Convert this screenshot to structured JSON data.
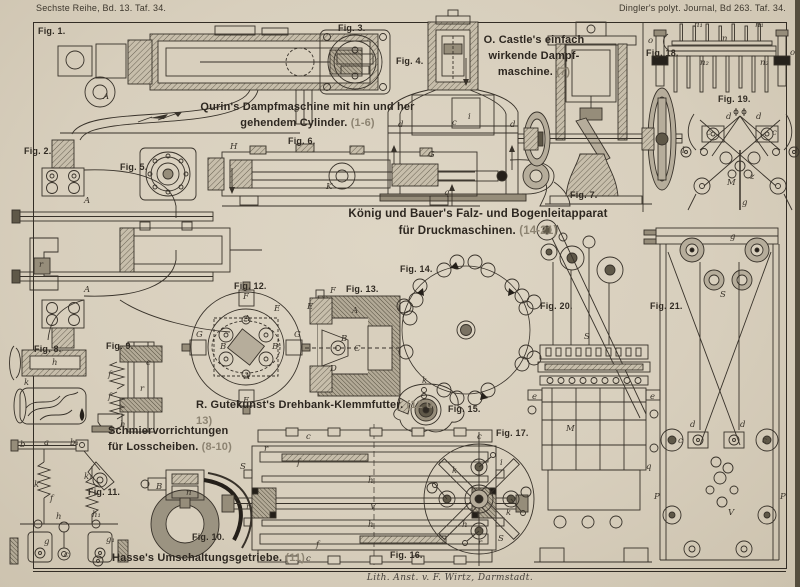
{
  "page": {
    "header_left": "Sechste Reihe, Bd. 13. Taf. 34.",
    "header_right": "Dingler's polyt. Journal, Bd 263. Taf. 34.",
    "imprint": "Lith. Anst. v. F. Wirtz, Darmstadt."
  },
  "colors": {
    "paper": "#d8cfbd",
    "ink": "#38322a",
    "metal_light": "#b6ad9b",
    "metal_mid": "#968d7a",
    "metal_dark": "#5f5848"
  },
  "captions": {
    "qurin": {
      "line1": "Qurin's Dampfmaschine mit hin und her",
      "line2": "gehendem Cylinder.",
      "ref": "(1-6)"
    },
    "castle": {
      "line1": "O. Castle's einfach",
      "line2": "wirkende Dampf-",
      "line3": "maschine.",
      "ref": "(7)"
    },
    "koenig": {
      "line1": "König und Bauer's Falz- und Bogenleitapparat",
      "line2": "für Druckmaschinen.",
      "ref": "(14-21)"
    },
    "gutekunst": {
      "text": "R. Gutekunst's Drehbank-Klemmfutter.",
      "ref": "(12 u. 13)"
    },
    "schmier": {
      "line1": "Schmiervorrichtungen",
      "line2": "für Losscheiben.",
      "ref": "(8-10)"
    },
    "hasse": {
      "text": "Hasse's Umschaltungsgetriebe.",
      "ref": "(11)"
    }
  },
  "figures": [
    {
      "id": "fig-1",
      "label": "Fig. 1."
    },
    {
      "id": "fig-2",
      "label": "Fig. 2."
    },
    {
      "id": "fig-3",
      "label": "Fig. 3."
    },
    {
      "id": "fig-4",
      "label": "Fig. 4."
    },
    {
      "id": "fig-5",
      "label": "Fig. 5."
    },
    {
      "id": "fig-6",
      "label": "Fig. 6."
    },
    {
      "id": "fig-7",
      "label": "Fig. 7."
    },
    {
      "id": "fig-8",
      "label": "Fig. 8."
    },
    {
      "id": "fig-9",
      "label": "Fig. 9."
    },
    {
      "id": "fig-10",
      "label": "Fig. 10."
    },
    {
      "id": "fig-11",
      "label": "Fig. 11."
    },
    {
      "id": "fig-12",
      "label": "Fig. 12."
    },
    {
      "id": "fig-13",
      "label": "Fig. 13."
    },
    {
      "id": "fig-14",
      "label": "Fig. 14."
    },
    {
      "id": "fig-15",
      "label": "Fig. 15."
    },
    {
      "id": "fig-16",
      "label": "Fig. 16."
    },
    {
      "id": "fig-17",
      "label": "Fig. 17."
    },
    {
      "id": "fig-18",
      "label": "Fig. 18."
    },
    {
      "id": "fig-19",
      "label": "Fig. 19."
    },
    {
      "id": "fig-20",
      "label": "Fig. 20."
    },
    {
      "id": "fig-21",
      "label": "Fig. 21."
    }
  ],
  "annotations": [
    {
      "x": 103,
      "y": 100,
      "t": "A"
    },
    {
      "x": 294,
      "y": 113,
      "t": "o"
    },
    {
      "x": 84,
      "y": 204,
      "t": "A"
    },
    {
      "x": 84,
      "y": 293,
      "t": "A"
    },
    {
      "x": 39,
      "y": 268,
      "t": "r"
    },
    {
      "x": 398,
      "y": 128,
      "t": "d"
    },
    {
      "x": 510,
      "y": 128,
      "t": "d"
    },
    {
      "x": 452,
      "y": 126,
      "t": "c"
    },
    {
      "x": 468,
      "y": 120,
      "t": "i"
    },
    {
      "x": 230,
      "y": 150,
      "t": "H"
    },
    {
      "x": 428,
      "y": 158,
      "t": "G"
    },
    {
      "x": 326,
      "y": 190,
      "t": "K"
    },
    {
      "x": 444,
      "y": 196,
      "t": "q"
    },
    {
      "x": 52,
      "y": 366,
      "t": "h"
    },
    {
      "x": 24,
      "y": 386,
      "t": "k"
    },
    {
      "x": 108,
      "y": 378,
      "t": "f"
    },
    {
      "x": 108,
      "y": 400,
      "t": "f"
    },
    {
      "x": 140,
      "y": 392,
      "t": "r"
    },
    {
      "x": 146,
      "y": 366,
      "t": "c"
    },
    {
      "x": 120,
      "y": 428,
      "t": "h"
    },
    {
      "x": 156,
      "y": 490,
      "t": "B"
    },
    {
      "x": 246,
      "y": 510,
      "t": "r"
    },
    {
      "x": 186,
      "y": 496,
      "t": "n"
    },
    {
      "x": 20,
      "y": 448,
      "t": "b"
    },
    {
      "x": 44,
      "y": 446,
      "t": "a"
    },
    {
      "x": 70,
      "y": 446,
      "t": "b₁"
    },
    {
      "x": 34,
      "y": 488,
      "t": "k"
    },
    {
      "x": 84,
      "y": 480,
      "t": "k₁"
    },
    {
      "x": 50,
      "y": 502,
      "t": "f"
    },
    {
      "x": 56,
      "y": 520,
      "t": "h"
    },
    {
      "x": 92,
      "y": 518,
      "t": "h₁"
    },
    {
      "x": 44,
      "y": 545,
      "t": "g"
    },
    {
      "x": 106,
      "y": 543,
      "t": "g₁"
    },
    {
      "x": 64,
      "y": 558,
      "t": "c"
    },
    {
      "x": 243,
      "y": 300,
      "t": "F"
    },
    {
      "x": 243,
      "y": 404,
      "t": "F"
    },
    {
      "x": 196,
      "y": 338,
      "t": "G"
    },
    {
      "x": 294,
      "y": 338,
      "t": "G"
    },
    {
      "x": 244,
      "y": 322,
      "t": "A"
    },
    {
      "x": 244,
      "y": 380,
      "t": "A"
    },
    {
      "x": 274,
      "y": 312,
      "t": "E"
    },
    {
      "x": 220,
      "y": 350,
      "t": "B"
    },
    {
      "x": 272,
      "y": 350,
      "t": "B"
    },
    {
      "x": 330,
      "y": 294,
      "t": "F"
    },
    {
      "x": 307,
      "y": 310,
      "t": "E"
    },
    {
      "x": 352,
      "y": 314,
      "t": "A"
    },
    {
      "x": 341,
      "y": 342,
      "t": "B"
    },
    {
      "x": 354,
      "y": 352,
      "t": "C"
    },
    {
      "x": 330,
      "y": 372,
      "t": "D"
    },
    {
      "x": 422,
      "y": 384,
      "t": "k"
    },
    {
      "x": 306,
      "y": 440,
      "t": "c"
    },
    {
      "x": 306,
      "y": 562,
      "t": "c"
    },
    {
      "x": 368,
      "y": 484,
      "t": "h"
    },
    {
      "x": 368,
      "y": 528,
      "t": "h"
    },
    {
      "x": 370,
      "y": 510,
      "t": "V"
    },
    {
      "x": 240,
      "y": 470,
      "t": "S"
    },
    {
      "x": 498,
      "y": 542,
      "t": "S"
    },
    {
      "x": 264,
      "y": 452,
      "t": "r"
    },
    {
      "x": 478,
      "y": 546,
      "t": "r"
    },
    {
      "x": 297,
      "y": 466,
      "t": "f"
    },
    {
      "x": 316,
      "y": 548,
      "t": "f"
    },
    {
      "x": 477,
      "y": 440,
      "t": "c"
    },
    {
      "x": 452,
      "y": 474,
      "t": "k"
    },
    {
      "x": 500,
      "y": 466,
      "t": "i"
    },
    {
      "x": 462,
      "y": 528,
      "t": "h"
    },
    {
      "x": 506,
      "y": 516,
      "t": "k"
    },
    {
      "x": 694,
      "y": 28,
      "t": "n₁"
    },
    {
      "x": 755,
      "y": 28,
      "t": "n₁"
    },
    {
      "x": 722,
      "y": 42,
      "t": "n"
    },
    {
      "x": 700,
      "y": 66,
      "t": "n₂"
    },
    {
      "x": 760,
      "y": 66,
      "t": "n₂"
    },
    {
      "x": 790,
      "y": 56,
      "t": "o"
    },
    {
      "x": 648,
      "y": 44,
      "t": "o"
    },
    {
      "x": 726,
      "y": 120,
      "t": "d"
    },
    {
      "x": 756,
      "y": 120,
      "t": "d"
    },
    {
      "x": 706,
      "y": 136,
      "t": "c"
    },
    {
      "x": 772,
      "y": 136,
      "t": "c"
    },
    {
      "x": 682,
      "y": 154,
      "t": "l"
    },
    {
      "x": 795,
      "y": 154,
      "t": "l"
    },
    {
      "x": 727,
      "y": 186,
      "t": "M"
    },
    {
      "x": 750,
      "y": 180,
      "t": "z"
    },
    {
      "x": 742,
      "y": 206,
      "t": "g"
    },
    {
      "x": 584,
      "y": 340,
      "t": "S"
    },
    {
      "x": 566,
      "y": 432,
      "t": "M"
    },
    {
      "x": 532,
      "y": 400,
      "t": "e"
    },
    {
      "x": 650,
      "y": 400,
      "t": "e"
    },
    {
      "x": 720,
      "y": 298,
      "t": "S"
    },
    {
      "x": 730,
      "y": 240,
      "t": "g"
    },
    {
      "x": 690,
      "y": 428,
      "t": "d"
    },
    {
      "x": 740,
      "y": 428,
      "t": "d"
    },
    {
      "x": 678,
      "y": 444,
      "t": "c"
    },
    {
      "x": 762,
      "y": 444,
      "t": "c"
    },
    {
      "x": 654,
      "y": 500,
      "t": "P"
    },
    {
      "x": 780,
      "y": 500,
      "t": "P"
    },
    {
      "x": 728,
      "y": 516,
      "t": "V"
    },
    {
      "x": 646,
      "y": 470,
      "t": "q"
    }
  ]
}
